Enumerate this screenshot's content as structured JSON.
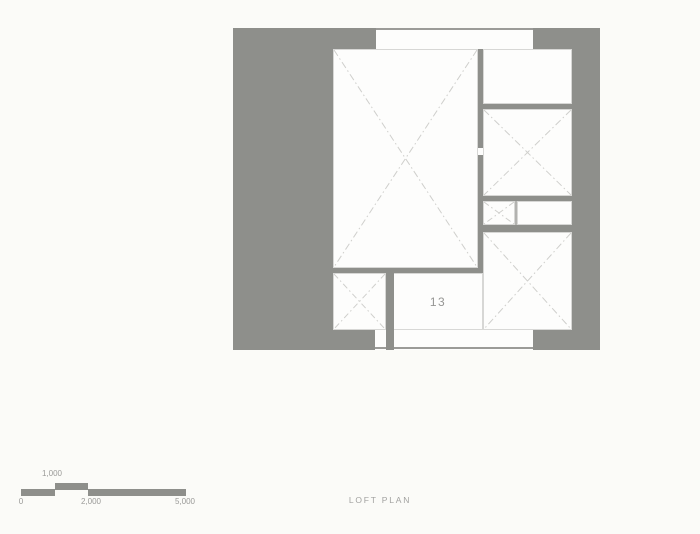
{
  "caption": {
    "text": "LOFT PLAN"
  },
  "plan": {
    "room_label": "13"
  },
  "scale": {
    "label_top": "1,000",
    "labels_bottom": [
      "0",
      "2,000",
      "5,000"
    ]
  },
  "colors": {
    "wall_gray": "#8e8f8b",
    "background": "#fbfbf8",
    "room_fill": "#fdfdfc",
    "room_outline": "#d7d7d5",
    "cross_line": "#cfcfcc",
    "label_gray": "#9a9a98"
  }
}
